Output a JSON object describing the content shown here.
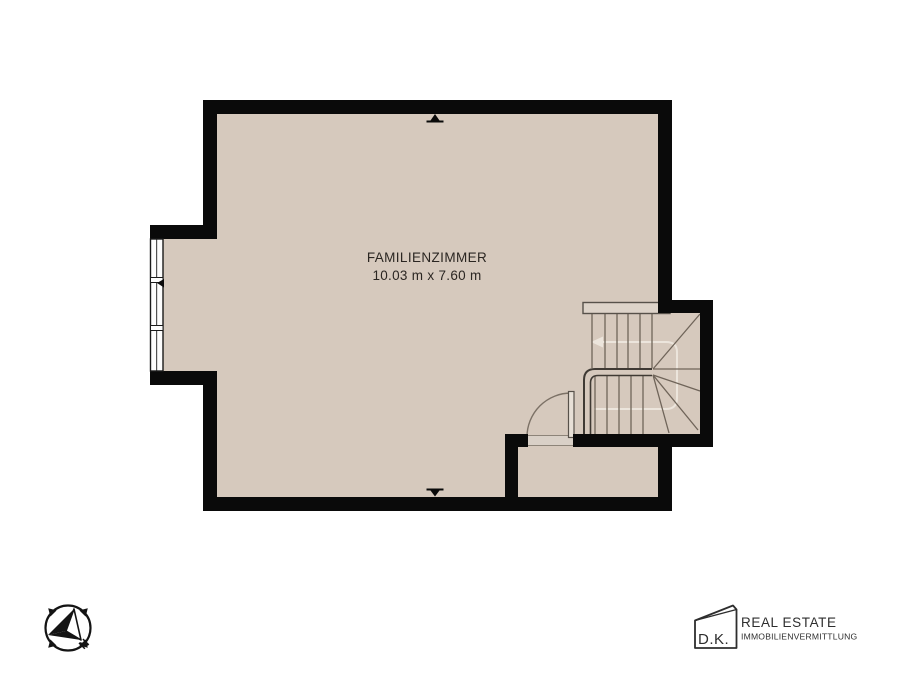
{
  "plan": {
    "room": {
      "name": "FAMILIENZIMMER",
      "dimensions": "10.03 m x 7.60 m"
    }
  },
  "compass": {
    "north_label": "N"
  },
  "branding": {
    "logo_monogram": "D.K.",
    "company_name": "REAL ESTATE",
    "company_subtitle": "IMMOBILIENVERMITTLUNG"
  },
  "colors": {
    "background": "#ffffff",
    "floor": "#d6c9bd",
    "wall": "#0a0a0a",
    "stair_line": "#6f6459",
    "handrail": "#3f3a34",
    "walk_line": "#ece5dc",
    "step_fill": "#ddd3c9",
    "door_sill": "#d9d0c7",
    "window_fill": "#fdfdfd",
    "label_text": "#2b2622",
    "brand_text": "#2e2e2e"
  }
}
